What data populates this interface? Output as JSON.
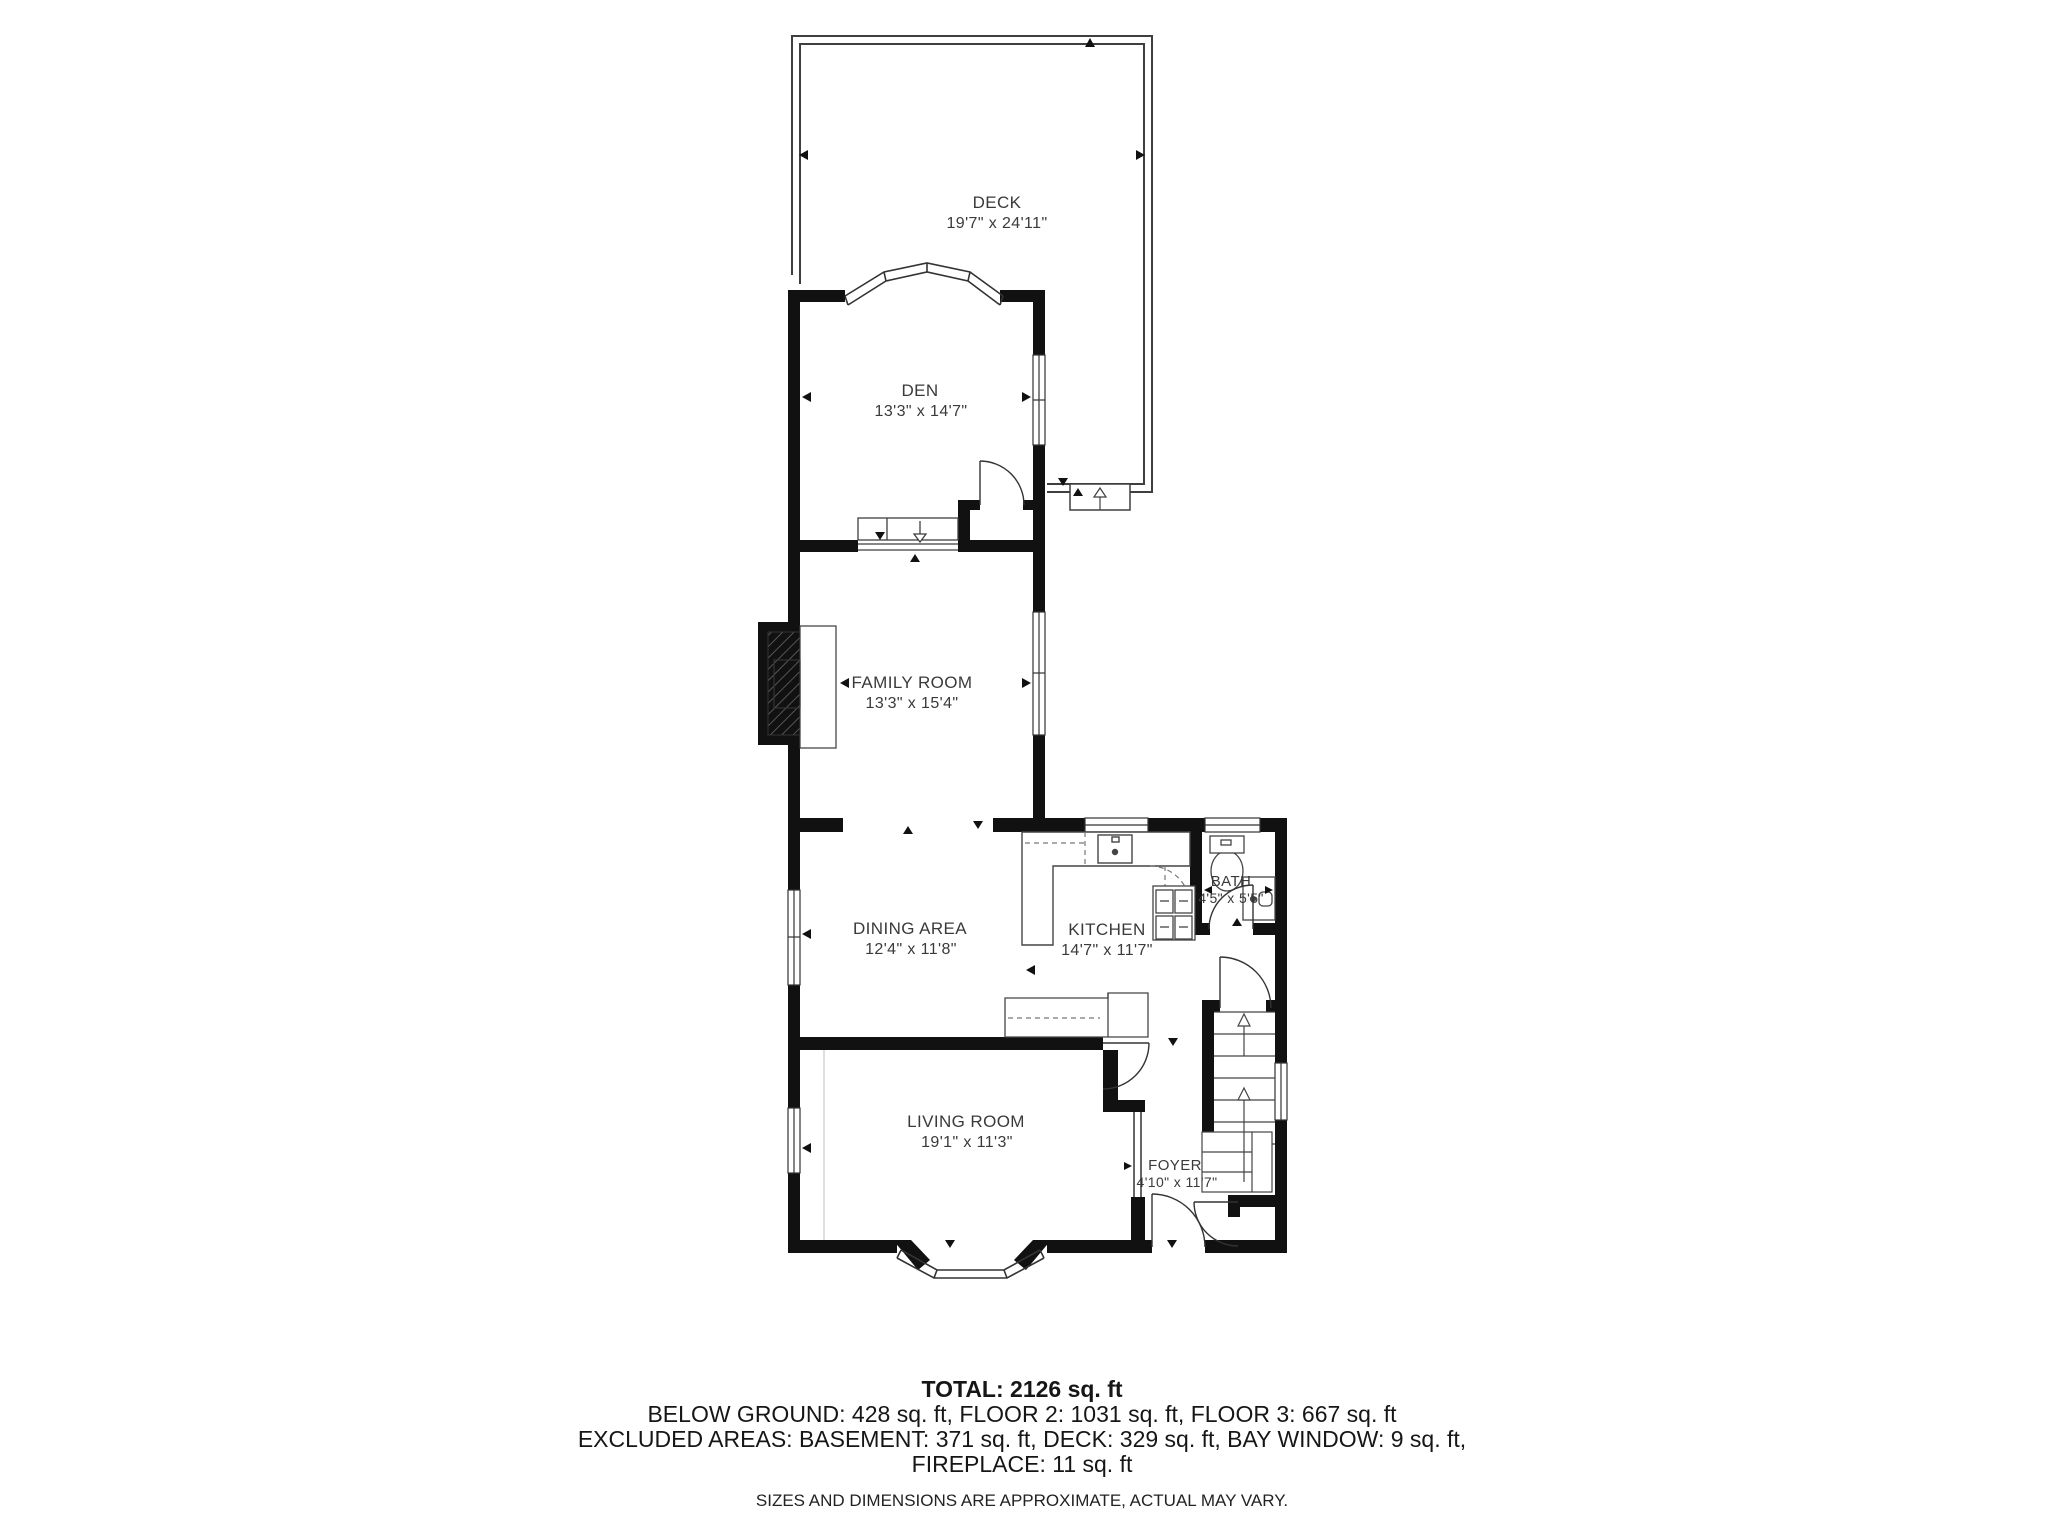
{
  "plan": {
    "background": "#ffffff",
    "wall_color": "#111111",
    "rooms": [
      {
        "id": "deck",
        "label": "DECK",
        "dims": "19'7\" x 24'11\""
      },
      {
        "id": "den",
        "label": "DEN",
        "dims": "13'3\" x 14'7\""
      },
      {
        "id": "family-room",
        "label": "FAMILY ROOM",
        "dims": "13'3\" x 15'4\""
      },
      {
        "id": "dining-area",
        "label": "DINING AREA",
        "dims": "12'4\" x 11'8\""
      },
      {
        "id": "kitchen",
        "label": "KITCHEN",
        "dims": "14'7\" x 11'7\""
      },
      {
        "id": "bath",
        "label": "BATH",
        "dims": "4'5\" x 5'5\""
      },
      {
        "id": "living-room",
        "label": "LIVING ROOM",
        "dims": "19'1\" x 11'3\""
      },
      {
        "id": "foyer",
        "label": "FOYER",
        "dims": "4'10\" x 11'7\""
      }
    ]
  },
  "summary": {
    "total": "TOTAL: 2126 sq. ft",
    "floors": "BELOW GROUND: 428 sq. ft, FLOOR 2: 1031 sq. ft, FLOOR 3: 667 sq. ft",
    "excluded1": "EXCLUDED AREAS: BASEMENT: 371 sq. ft, DECK: 329 sq. ft, BAY WINDOW: 9 sq. ft,",
    "excluded2": "FIREPLACE: 11 sq. ft",
    "disclaimer": "SIZES AND DIMENSIONS ARE APPROXIMATE, ACTUAL MAY VARY."
  }
}
